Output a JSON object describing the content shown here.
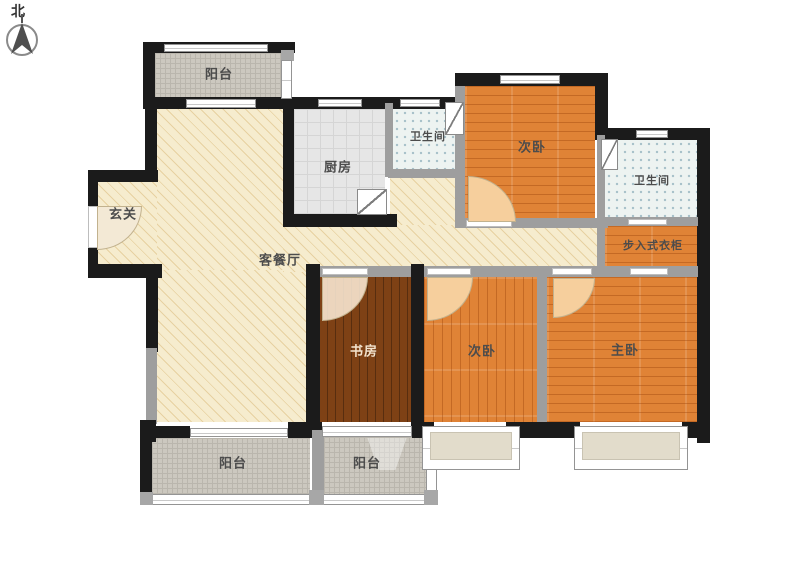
{
  "compass": {
    "north_label": "北"
  },
  "rooms": {
    "balcony_top": {
      "label": "阳台"
    },
    "kitchen": {
      "label": "厨房"
    },
    "bath_top": {
      "label": "卫生间"
    },
    "bedroom_top_right": {
      "label": "次卧"
    },
    "bath_right": {
      "label": "卫生间"
    },
    "walk_in_closet": {
      "label": "步入式衣柜"
    },
    "entry": {
      "label": "玄关"
    },
    "living_dining": {
      "label": "客餐厅"
    },
    "study": {
      "label": "书房"
    },
    "bedroom_middle": {
      "label": "次卧"
    },
    "bedroom_master": {
      "label": "主卧"
    },
    "balcony_bottom_left": {
      "label": "阳台"
    },
    "balcony_bottom_mid": {
      "label": "阳台"
    }
  },
  "colors": {
    "wall": "#1b1b1b",
    "wall_light": "#9e9e9e",
    "wood_orange": "#e08336",
    "wood_dark": "#7e4115",
    "living_floor": "#f6ecce",
    "bath_floor": "#edf3f1",
    "kitchen_floor": "#e6e6e6",
    "balcony_floor": "#ccc8bf"
  }
}
